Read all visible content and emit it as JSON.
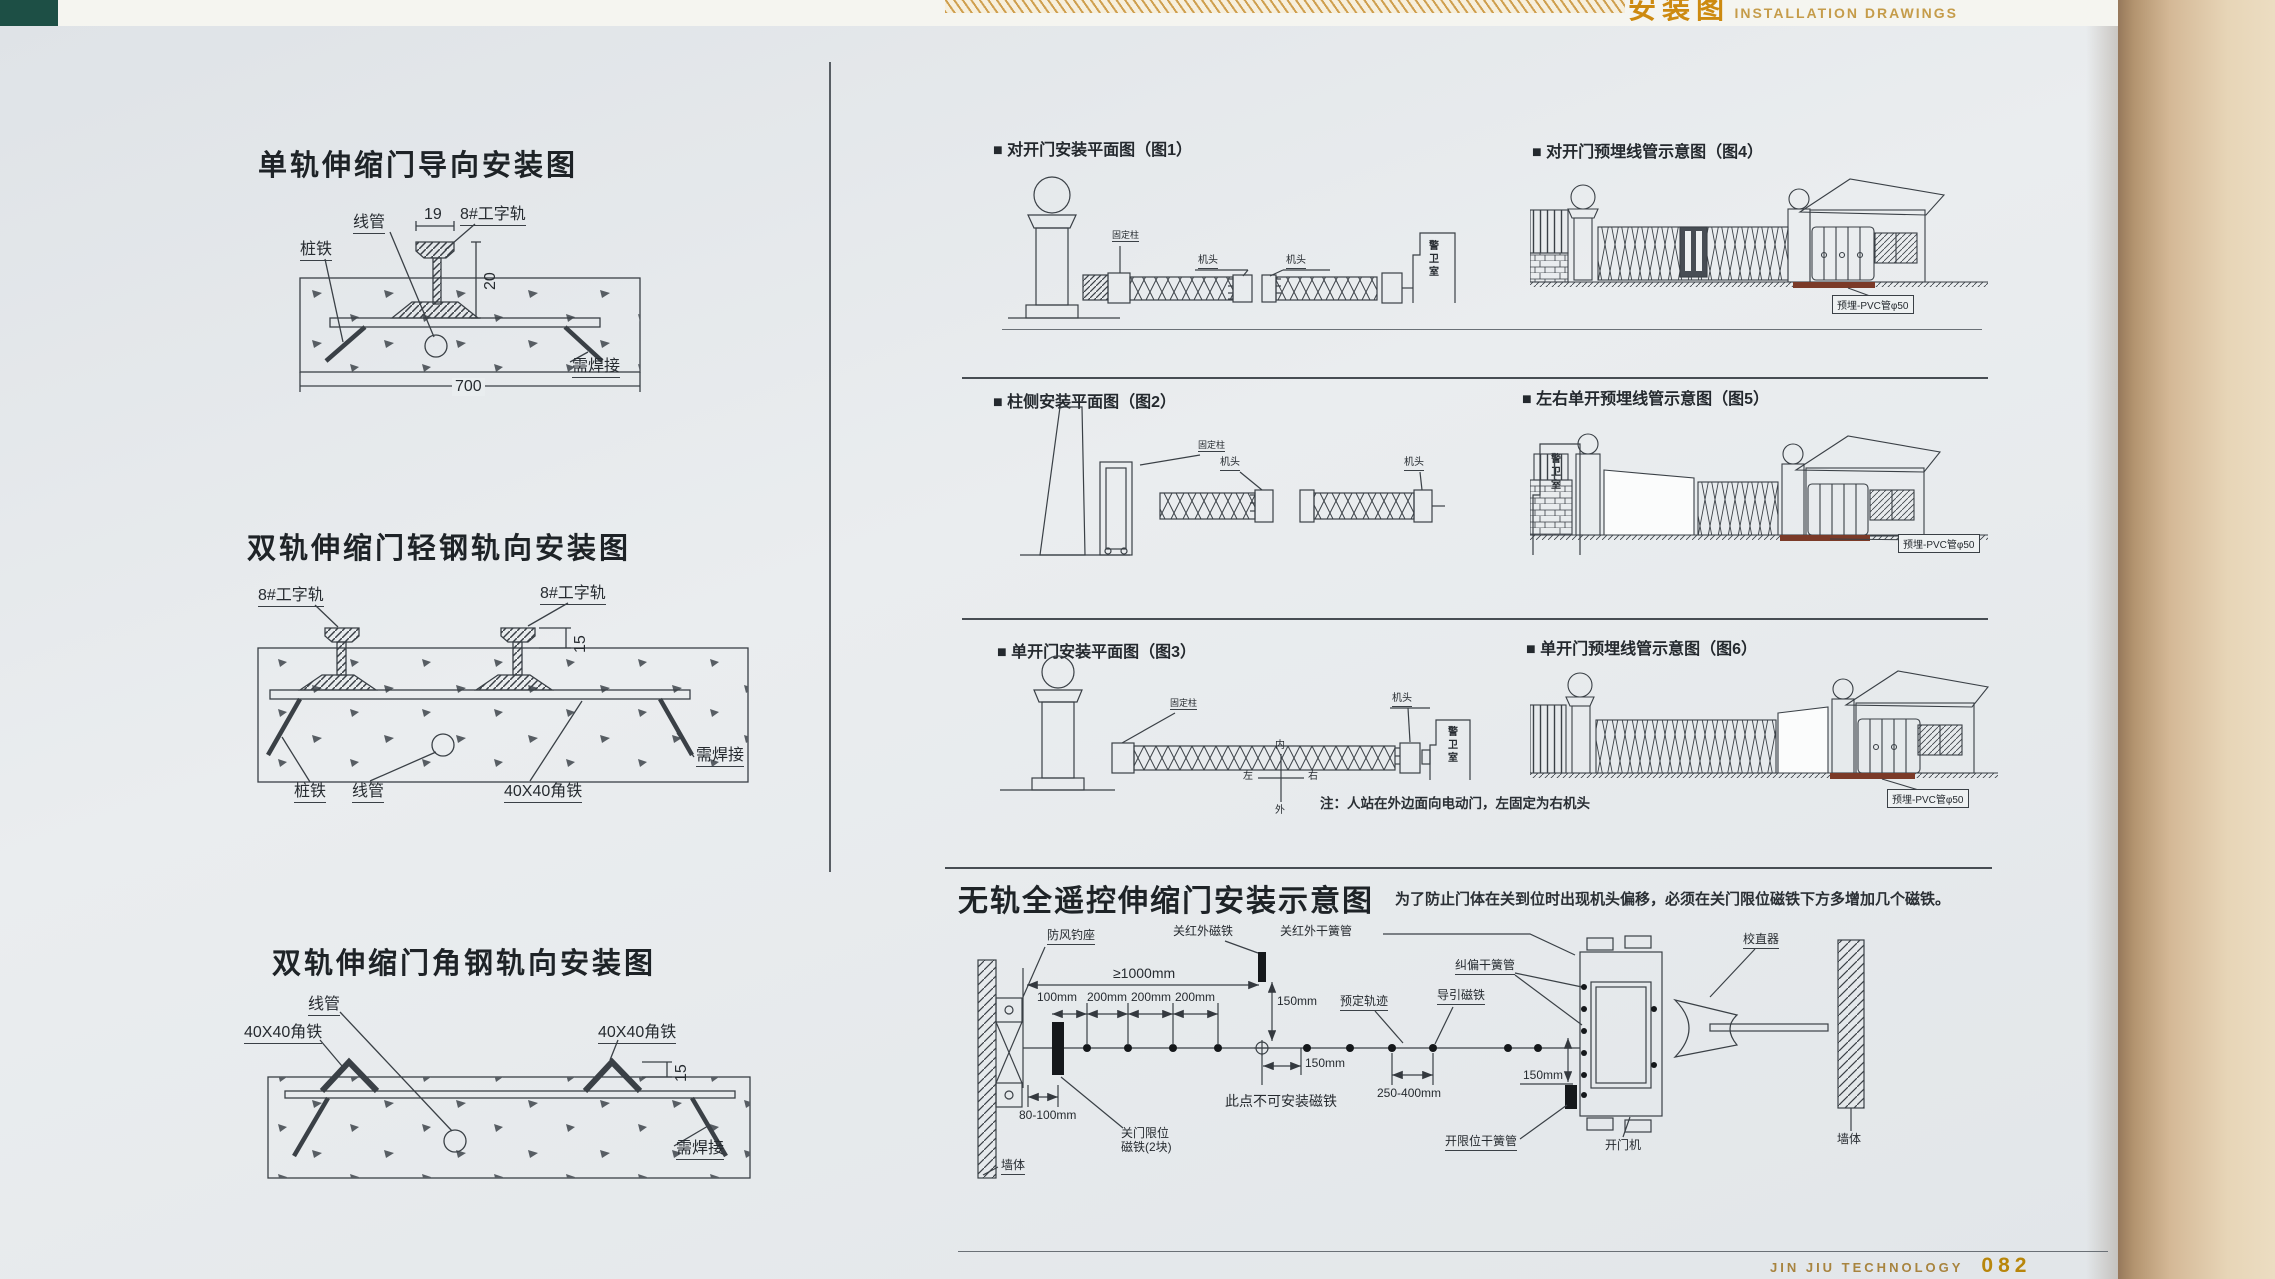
{
  "header": {
    "series_cn": "安装图",
    "series_en": "INSTALLATION DRAWINGS"
  },
  "footer": {
    "brand": "JIN JIU TECHNOLOGY",
    "page_no": "082"
  },
  "terms": {
    "conduit": "线管",
    "pile_iron": "桩铁",
    "i_rail": "8#工字轨",
    "weld_needed": "需焊接",
    "angle_iron": "40X40角铁",
    "fixed_post": "固定柱",
    "machine_head": "机头",
    "guard_room": "警卫室",
    "pvc_buried": "预埋-PVC管φ50",
    "d19": "19",
    "d20": "20",
    "d700": "700",
    "d15": "15"
  },
  "left": {
    "title1": "单轨伸缩门导向安装图",
    "title2": "双轨伸缩门轻钢轨向安装图",
    "title3": "双轨伸缩门角钢轨向安装图"
  },
  "figs": {
    "f1": "■ 对开门安装平面图（图1）",
    "f2": "■ 柱侧安装平面图（图2）",
    "f3": "■ 单开门安装平面图（图3）",
    "f4": "■ 对开门预埋线管示意图（图4）",
    "f5": "■ 左右单开预埋线管示意图（图5）",
    "f6": "■ 单开门预埋线管示意图（图6）",
    "note": "注：人站在外边面向电动门，左固定为右机头",
    "compass": {
      "n": "内",
      "s": "外",
      "w": "左",
      "e": "右"
    }
  },
  "trackless": {
    "title": "无轨全遥控伸缩门安装示意图",
    "note": "为了防止门体在关到位时出现机头偏移，必须在关门限位磁铁下方多增加几个磁铁。",
    "wind_hook": "防风钓座",
    "close_ir_magnet": "关红外磁铁",
    "close_ir_reed": "关红外干簧管",
    "straightener": "校直器",
    "deviation_reed": "纠偏干簧管",
    "planned_track": "预定轨迹",
    "guide_magnet": "导引磁铁",
    "no_magnet_here": "此点不可安装磁铁",
    "close_limit_magnet": "关门限位磁铁(2块)",
    "open_limit_reed": "开限位干簧管",
    "door_operator": "开门机",
    "wall": "墙体",
    "dim_gte_1000": "≥1000mm",
    "dim_100": "100mm",
    "dim_200": "200mm",
    "dim_150": "150mm",
    "dim_80_100": "80-100mm",
    "dim_250_400": "250-400mm"
  }
}
